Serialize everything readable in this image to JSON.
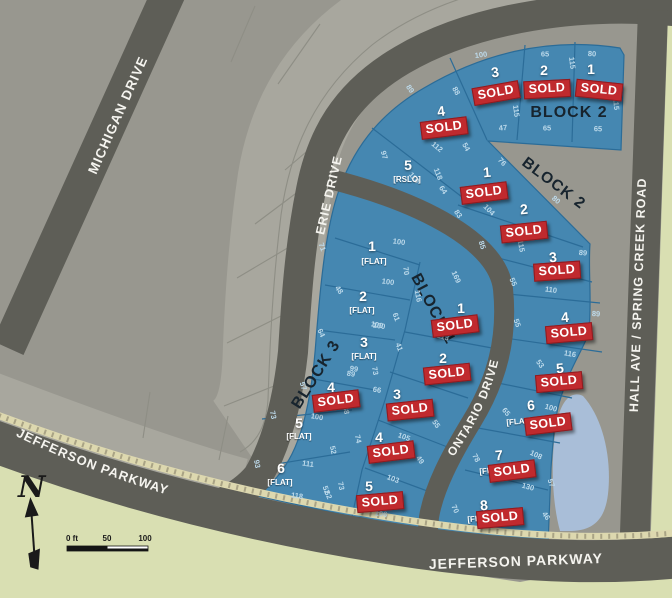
{
  "map_labels": {
    "michigan": "MICHIGAN DRIVE",
    "erie": "ERIE DRIVE",
    "ontario": "ONTARIO DRIVE",
    "jefferson_curved": "JEFFERSON PARKWAY",
    "jefferson_bottom": "JEFFERSON PARKWAY",
    "hall": "HALL AVE / SPRING CREEK ROAD",
    "block1": "BLOCK 1",
    "block2_top": "BLOCK 2",
    "block2_wedge": "BLOCK 2",
    "block3": "BLOCK 3",
    "compass_n": "N"
  },
  "scale_bar": {
    "labels": [
      "0 ft",
      "50",
      "100"
    ]
  },
  "sold_label": "SOLD",
  "colors": {
    "bg_green": "#d9dfb2",
    "olive": "#7d9032",
    "land_gray": "#98978f",
    "land_gray_light": "#a8a79e",
    "land_line": "#8e8e85",
    "road_gray": "#5e5e57",
    "road_label": "#f5f4ef",
    "lot_blue": "#4587b1",
    "lot_line": "#2b6c98",
    "dim_text": "#bddaeb",
    "sold_red": "#c02a2e",
    "sold_border": "#8e1b20",
    "block_text": "#17242e",
    "sidewalk": "#ddd8af",
    "sidewalk_tick": "#a9a385",
    "pond_blue": "#a9bed8",
    "scale_text": "#1a1a1a"
  },
  "lots": [
    {
      "block": "2",
      "n": "3",
      "x": 495,
      "y": 72,
      "r": -8,
      "s": {
        "x": 496,
        "y": 93,
        "r": -10
      }
    },
    {
      "block": "2",
      "n": "2",
      "x": 544,
      "y": 70,
      "s": {
        "x": 547,
        "y": 89,
        "r": -3
      }
    },
    {
      "block": "2",
      "n": "1",
      "x": 591,
      "y": 69,
      "s": {
        "x": 599,
        "y": 90,
        "r": 6
      }
    },
    {
      "block": "2",
      "n": "4",
      "x": 441,
      "y": 111,
      "r": -8,
      "s": {
        "x": 444,
        "y": 128,
        "r": -7
      }
    },
    {
      "block": "2",
      "n": "5",
      "x": 408,
      "y": 165,
      "d": "[RSLO]",
      "dx": 407,
      "dy": 180
    },
    {
      "block": "2",
      "n": "1",
      "x": 487,
      "y": 172,
      "r": -5,
      "s": {
        "x": 484,
        "y": 193,
        "r": -7
      }
    },
    {
      "block": "2",
      "n": "2",
      "x": 524,
      "y": 209,
      "r": -5,
      "s": {
        "x": 524,
        "y": 232,
        "r": -6
      }
    },
    {
      "block": "2",
      "n": "3",
      "x": 553,
      "y": 257,
      "r": -5,
      "s": {
        "x": 557,
        "y": 271,
        "r": -4
      }
    },
    {
      "block": "2",
      "n": "4",
      "x": 565,
      "y": 317,
      "r": -5,
      "s": {
        "x": 569,
        "y": 333,
        "r": -5
      }
    },
    {
      "block": "2",
      "n": "5",
      "x": 560,
      "y": 368,
      "r": -5,
      "s": {
        "x": 559,
        "y": 382,
        "r": -5
      }
    },
    {
      "block": "2",
      "n": "6",
      "x": 531,
      "y": 405,
      "r": -5,
      "d": "[FLAT]",
      "dx": 519,
      "dy": 422,
      "s": {
        "x": 548,
        "y": 424,
        "r": -7
      }
    },
    {
      "block": "2",
      "n": "7",
      "x": 499,
      "y": 455,
      "r": -5,
      "d": "[FLAT]",
      "dx": 492,
      "dy": 471,
      "s": {
        "x": 512,
        "y": 471,
        "r": -7
      }
    },
    {
      "block": "2",
      "n": "8",
      "x": 484,
      "y": 505,
      "r": -5,
      "d": "[FLAT]",
      "dx": 480,
      "dy": 519,
      "s": {
        "x": 500,
        "y": 518,
        "r": -5
      }
    },
    {
      "block": "1",
      "n": "1",
      "x": 461,
      "y": 308,
      "s": {
        "x": 455,
        "y": 326,
        "r": -7
      }
    },
    {
      "block": "1",
      "n": "2",
      "x": 443,
      "y": 358,
      "s": {
        "x": 447,
        "y": 374,
        "r": -6
      }
    },
    {
      "block": "1",
      "n": "3",
      "x": 397,
      "y": 394,
      "s": {
        "x": 410,
        "y": 410,
        "r": -6
      }
    },
    {
      "block": "1",
      "n": "4",
      "x": 379,
      "y": 437,
      "s": {
        "x": 391,
        "y": 452,
        "r": -7
      }
    },
    {
      "block": "1",
      "n": "5",
      "x": 369,
      "y": 486,
      "s": {
        "x": 380,
        "y": 502,
        "r": -5
      }
    },
    {
      "block": "3",
      "n": "1",
      "x": 372,
      "y": 246,
      "d": "[FLAT]",
      "dx": 374,
      "dy": 262
    },
    {
      "block": "3",
      "n": "2",
      "x": 363,
      "y": 296,
      "d": "[FLAT]",
      "dx": 362,
      "dy": 311
    },
    {
      "block": "3",
      "n": "3",
      "x": 364,
      "y": 342,
      "d": "[FLAT]",
      "dx": 364,
      "dy": 357
    },
    {
      "block": "3",
      "n": "4",
      "x": 331,
      "y": 387,
      "s": {
        "x": 336,
        "y": 401,
        "r": -7
      }
    },
    {
      "block": "3",
      "n": "5",
      "x": 299,
      "y": 423,
      "d": "[FLAT]",
      "dx": 299,
      "dy": 437
    },
    {
      "block": "3",
      "n": "6",
      "x": 281,
      "y": 468,
      "d": "[FLAT]",
      "dx": 280,
      "dy": 483
    }
  ],
  "dimensions": [
    {
      "t": "100",
      "x": 481,
      "y": 55,
      "r": -8
    },
    {
      "t": "65",
      "x": 545,
      "y": 54,
      "r": 0
    },
    {
      "t": "80",
      "x": 592,
      "y": 54,
      "r": 3
    },
    {
      "t": "115",
      "x": 572,
      "y": 63,
      "r": 83
    },
    {
      "t": "115",
      "x": 616,
      "y": 104,
      "r": 85
    },
    {
      "t": "115",
      "x": 516,
      "y": 111,
      "r": 82
    },
    {
      "t": "47",
      "x": 503,
      "y": 128,
      "r": -5
    },
    {
      "t": "65",
      "x": 547,
      "y": 128,
      "r": 0
    },
    {
      "t": "65",
      "x": 598,
      "y": 129,
      "r": 2
    },
    {
      "t": "89",
      "x": 410,
      "y": 89,
      "r": 55
    },
    {
      "t": "88",
      "x": 456,
      "y": 91,
      "r": 60
    },
    {
      "t": "112",
      "x": 437,
      "y": 147,
      "r": 40
    },
    {
      "t": "54",
      "x": 466,
      "y": 147,
      "r": 60
    },
    {
      "t": "97",
      "x": 384,
      "y": 155,
      "r": 75
    },
    {
      "t": "110",
      "x": 414,
      "y": 178,
      "r": 50
    },
    {
      "t": "118",
      "x": 438,
      "y": 174,
      "r": 68
    },
    {
      "t": "64",
      "x": 443,
      "y": 190,
      "r": 55
    },
    {
      "t": "76",
      "x": 502,
      "y": 162,
      "r": 48
    },
    {
      "t": "83",
      "x": 458,
      "y": 214,
      "r": 55
    },
    {
      "t": "104",
      "x": 489,
      "y": 210,
      "r": 45
    },
    {
      "t": "85",
      "x": 482,
      "y": 245,
      "r": 72
    },
    {
      "t": "115",
      "x": 521,
      "y": 246,
      "r": 80
    },
    {
      "t": "80",
      "x": 556,
      "y": 200,
      "r": 40
    },
    {
      "t": "89",
      "x": 583,
      "y": 253,
      "r": 5
    },
    {
      "t": "110",
      "x": 551,
      "y": 290,
      "r": 8
    },
    {
      "t": "55",
      "x": 513,
      "y": 282,
      "r": 65
    },
    {
      "t": "89",
      "x": 596,
      "y": 314,
      "r": 3
    },
    {
      "t": "55",
      "x": 517,
      "y": 323,
      "r": 70
    },
    {
      "t": "116",
      "x": 570,
      "y": 354,
      "r": 10
    },
    {
      "t": "53",
      "x": 540,
      "y": 364,
      "r": 55
    },
    {
      "t": "100",
      "x": 551,
      "y": 408,
      "r": 15
    },
    {
      "t": "65",
      "x": 506,
      "y": 412,
      "r": 50
    },
    {
      "t": "78",
      "x": 476,
      "y": 458,
      "r": 60
    },
    {
      "t": "108",
      "x": 536,
      "y": 455,
      "r": 25
    },
    {
      "t": "130",
      "x": 528,
      "y": 487,
      "r": 15
    },
    {
      "t": "57",
      "x": 551,
      "y": 483,
      "r": 70
    },
    {
      "t": "70",
      "x": 455,
      "y": 509,
      "r": 65
    },
    {
      "t": "46",
      "x": 546,
      "y": 516,
      "r": 55
    },
    {
      "t": "169",
      "x": 456,
      "y": 277,
      "r": 65
    },
    {
      "t": "116",
      "x": 418,
      "y": 296,
      "r": 80
    },
    {
      "t": "61",
      "x": 396,
      "y": 317,
      "r": 70
    },
    {
      "t": "100",
      "x": 377,
      "y": 325,
      "r": 10
    },
    {
      "t": "41",
      "x": 399,
      "y": 347,
      "r": 70
    },
    {
      "t": "113",
      "x": 443,
      "y": 337,
      "r": 15
    },
    {
      "t": "99",
      "x": 354,
      "y": 369,
      "r": 8
    },
    {
      "t": "73",
      "x": 375,
      "y": 371,
      "r": 80
    },
    {
      "t": "66",
      "x": 377,
      "y": 390,
      "r": 10
    },
    {
      "t": "55",
      "x": 436,
      "y": 424,
      "r": 55
    },
    {
      "t": "74",
      "x": 358,
      "y": 439,
      "r": 78
    },
    {
      "t": "105",
      "x": 404,
      "y": 437,
      "r": 20
    },
    {
      "t": "49",
      "x": 420,
      "y": 460,
      "r": 55
    },
    {
      "t": "103",
      "x": 393,
      "y": 479,
      "r": 20
    },
    {
      "t": "73",
      "x": 341,
      "y": 486,
      "r": 78
    },
    {
      "t": "62",
      "x": 328,
      "y": 495,
      "r": 65
    },
    {
      "t": "106",
      "x": 381,
      "y": 514,
      "r": 8
    },
    {
      "t": "71",
      "x": 322,
      "y": 247,
      "r": 70
    },
    {
      "t": "100",
      "x": 399,
      "y": 242,
      "r": 8
    },
    {
      "t": "70",
      "x": 406,
      "y": 271,
      "r": 83
    },
    {
      "t": "100",
      "x": 388,
      "y": 282,
      "r": 8
    },
    {
      "t": "48",
      "x": 339,
      "y": 290,
      "r": 55
    },
    {
      "t": "64",
      "x": 321,
      "y": 333,
      "r": 65
    },
    {
      "t": "100",
      "x": 379,
      "y": 326,
      "r": 8
    },
    {
      "t": "57",
      "x": 303,
      "y": 386,
      "r": 72
    },
    {
      "t": "89",
      "x": 351,
      "y": 374,
      "r": 8
    },
    {
      "t": "100",
      "x": 317,
      "y": 417,
      "r": 10
    },
    {
      "t": "88",
      "x": 346,
      "y": 410,
      "r": 80
    },
    {
      "t": "73",
      "x": 273,
      "y": 415,
      "r": 78
    },
    {
      "t": "52",
      "x": 333,
      "y": 450,
      "r": 78
    },
    {
      "t": "111",
      "x": 308,
      "y": 464,
      "r": 8
    },
    {
      "t": "93",
      "x": 257,
      "y": 464,
      "r": 80
    },
    {
      "t": "118",
      "x": 297,
      "y": 496,
      "r": 8
    },
    {
      "t": "52",
      "x": 326,
      "y": 490,
      "r": 70
    }
  ]
}
